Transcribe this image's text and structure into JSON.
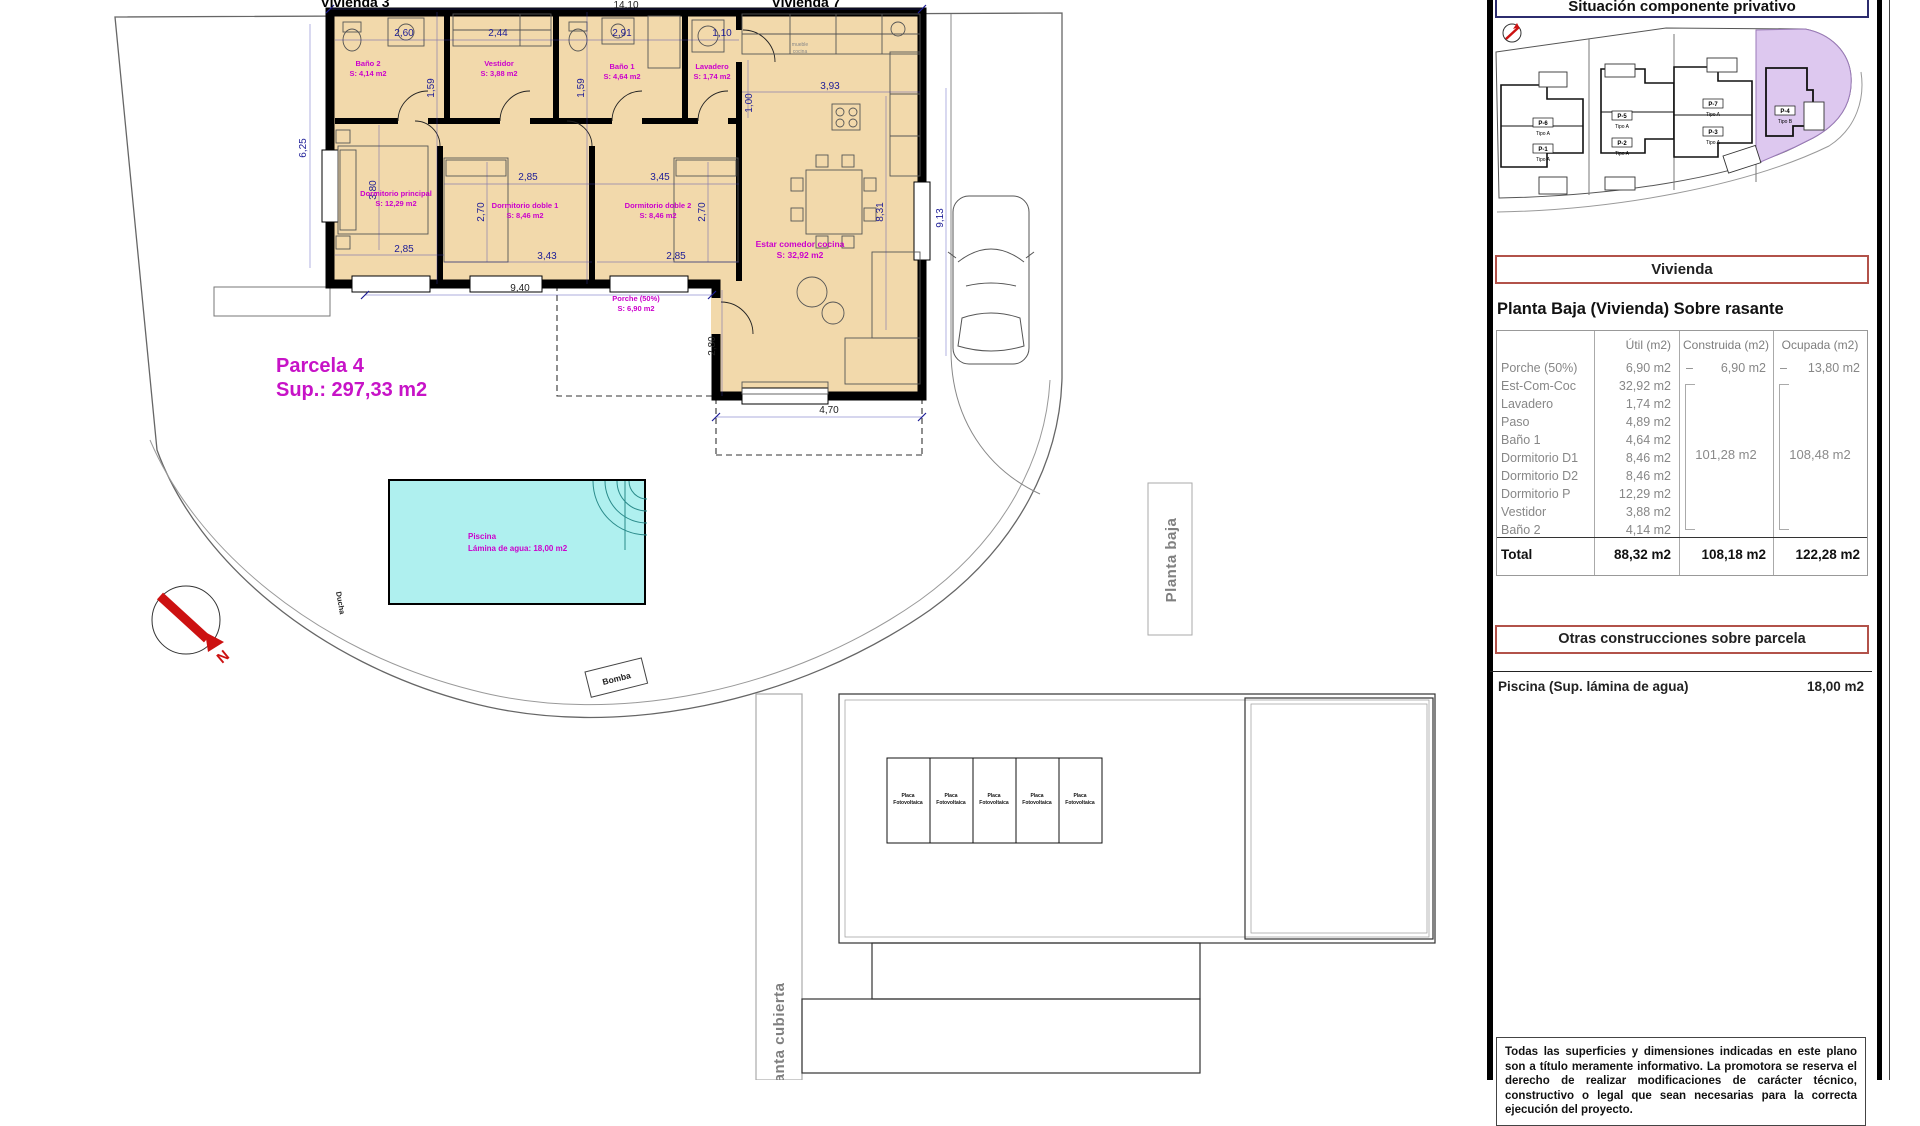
{
  "plan": {
    "house_labels": {
      "left": "Vivienda 3",
      "right": "Vivienda 7"
    },
    "parcela": {
      "title": "Parcela 4",
      "sup": "Sup.: 297,33 m2"
    },
    "rooms": {
      "bano2": {
        "name": "Baño 2",
        "area": "S: 4,14 m2"
      },
      "vestidor": {
        "name": "Vestidor",
        "area": "S: 3,88 m2"
      },
      "bano1": {
        "name": "Baño 1",
        "area": "S: 4,64 m2"
      },
      "lavadero": {
        "name": "Lavadero",
        "area": "S: 1,74 m2"
      },
      "dormp": {
        "name": "Dormitorio principal",
        "area": "S: 12,29 m2"
      },
      "dd1": {
        "name": "Dormitorio doble 1",
        "area": "S: 8,46 m2"
      },
      "dd2": {
        "name": "Dormitorio doble 2",
        "area": "S: 8,46 m2"
      },
      "estar": {
        "name": "Estar comedor cocina",
        "area": "S: 32,92 m2"
      },
      "porche": {
        "name": "Porche (50%)",
        "area": "S: 6,90 m2"
      }
    },
    "pool": {
      "name": "Piscina",
      "area": "Lámina de agua: 18,00 m2"
    },
    "dims": {
      "total_w": "14.10",
      "bano2_w": "2,60",
      "vestidor_w": "2,44",
      "bano1_w": "2,91",
      "lavadero_w": "1,10",
      "hall1": "1,59",
      "hall2": "1,59",
      "left_h": "6,25",
      "kitchen_w": "3,93",
      "kitchen_d": "1,00",
      "dormp_h": "3,80",
      "dormp_w": "2,85",
      "dd1_w": "2,85",
      "dd1_h": "2,70",
      "dd1_wb": "3,43",
      "dd2_w": "3,45",
      "dd2_h": "2,70",
      "dd2_wb": "2,85",
      "estar_h": "8,31",
      "side_h": "9,13",
      "porch_w": "9,40",
      "ext_h": "2,80",
      "ext_w": "4,70"
    },
    "annotations": {
      "ducha": "Ducha",
      "bomba": "Bomba",
      "north": "N",
      "kitchen_note1": "mueble",
      "kitchen_note2": "cocina"
    },
    "strips": {
      "planta_baja": "Planta baja",
      "planta_cubierta": "Planta cubierta"
    },
    "solar": {
      "line1": "Placa",
      "line2": "Fotovoltaica"
    }
  },
  "panel": {
    "situacion_title": "Situación componente privativo",
    "site": {
      "parcels": [
        {
          "code": "P-6",
          "tipo": "Tipo A"
        },
        {
          "code": "P-1",
          "tipo": "Tipo A"
        },
        {
          "code": "P-5",
          "tipo": "Tipo A"
        },
        {
          "code": "P-2",
          "tipo": "Tipo A"
        },
        {
          "code": "P-7",
          "tipo": "Tipo A"
        },
        {
          "code": "P-3",
          "tipo": "Tipo A"
        },
        {
          "code": "P-4",
          "tipo": "Tipo B"
        }
      ]
    },
    "vivienda_title": "Vivienda",
    "planta_heading": "Planta Baja (Vivienda) Sobre rasante",
    "table": {
      "headers": [
        "Útil (m2)",
        "Construida (m2)",
        "Ocupada (m2)"
      ],
      "dash": "–",
      "rows": [
        {
          "label": "Porche (50%)",
          "util": "6,90 m2",
          "construida": "6,90 m2",
          "ocupada": "13,80 m2"
        },
        {
          "label": "Est-Com-Coc",
          "util": "32,92 m2"
        },
        {
          "label": "Lavadero",
          "util": "1,74 m2"
        },
        {
          "label": "Paso",
          "util": "4,89 m2"
        },
        {
          "label": "Baño 1",
          "util": "4,64 m2"
        },
        {
          "label": "Dormitorio D1",
          "util": "8,46 m2"
        },
        {
          "label": "Dormitorio D2",
          "util": "8,46 m2"
        },
        {
          "label": "Dormitorio P",
          "util": "12,29 m2"
        },
        {
          "label": "Vestidor",
          "util": "3,88 m2"
        },
        {
          "label": "Baño 2",
          "util": "4,14 m2"
        }
      ],
      "group_construida": "101,28 m2",
      "group_ocupada": "108,48 m2",
      "total": {
        "label": "Total",
        "util": "88,32 m2",
        "construida": "108,18 m2",
        "ocupada": "122,28 m2"
      }
    },
    "otras_title": "Otras construcciones sobre parcela",
    "piscina": {
      "label": "Piscina (Sup. lámina de agua)",
      "value": "18,00 m2"
    },
    "disclaimer": "Todas las superficies y dimensiones indicadas en este plano son a título meramente informativo. La promotora se reserva el derecho de realizar modificaciones de carácter técnico, constructivo o legal que sean necesarias para la correcta ejecución del proyecto."
  },
  "colors": {
    "room_fill": "#f2d9ab",
    "dim_blue": "#1c1c96",
    "label_magenta": "#cc00cc",
    "pool_fill": "#aff0ef",
    "header_red": "#b2524a",
    "situacion_blue": "#2c2c6e",
    "parcel_purple": "#ddc8ef"
  }
}
